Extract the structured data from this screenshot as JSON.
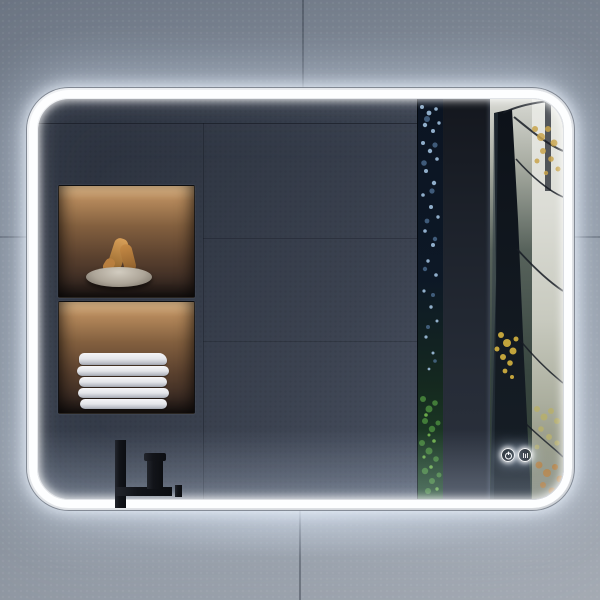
{
  "product": {
    "kind": "led-bathroom-mirror",
    "led_color": "#fdfeff",
    "frame_color": "#c6cbd1"
  },
  "wall": {
    "tile_color": "#8a92a0",
    "grout_color": "#2c323e"
  },
  "reflection": {
    "wall_color": "#3c4350",
    "faucet_color": "#121419",
    "niches": [
      {
        "name": "upper-niche",
        "contents": "stone-bowl-with-dried-decor",
        "light_color": "#e3bd8d"
      },
      {
        "name": "lower-niche",
        "contents": "folded-towels",
        "light_color": "#e3bd8d",
        "towel_count": 5
      }
    ],
    "forest": {
      "trunk_color": "#10161d",
      "mist_color": "#dbdcd5",
      "foliage_colors": [
        "#c8a44c",
        "#d6b33f",
        "#4d8f3f",
        "#a8c9e8",
        "#b5762c"
      ]
    }
  },
  "touch_controls": [
    {
      "name": "power-button",
      "icon": "power-icon"
    },
    {
      "name": "defog-button",
      "icon": "defog-icon"
    }
  ]
}
